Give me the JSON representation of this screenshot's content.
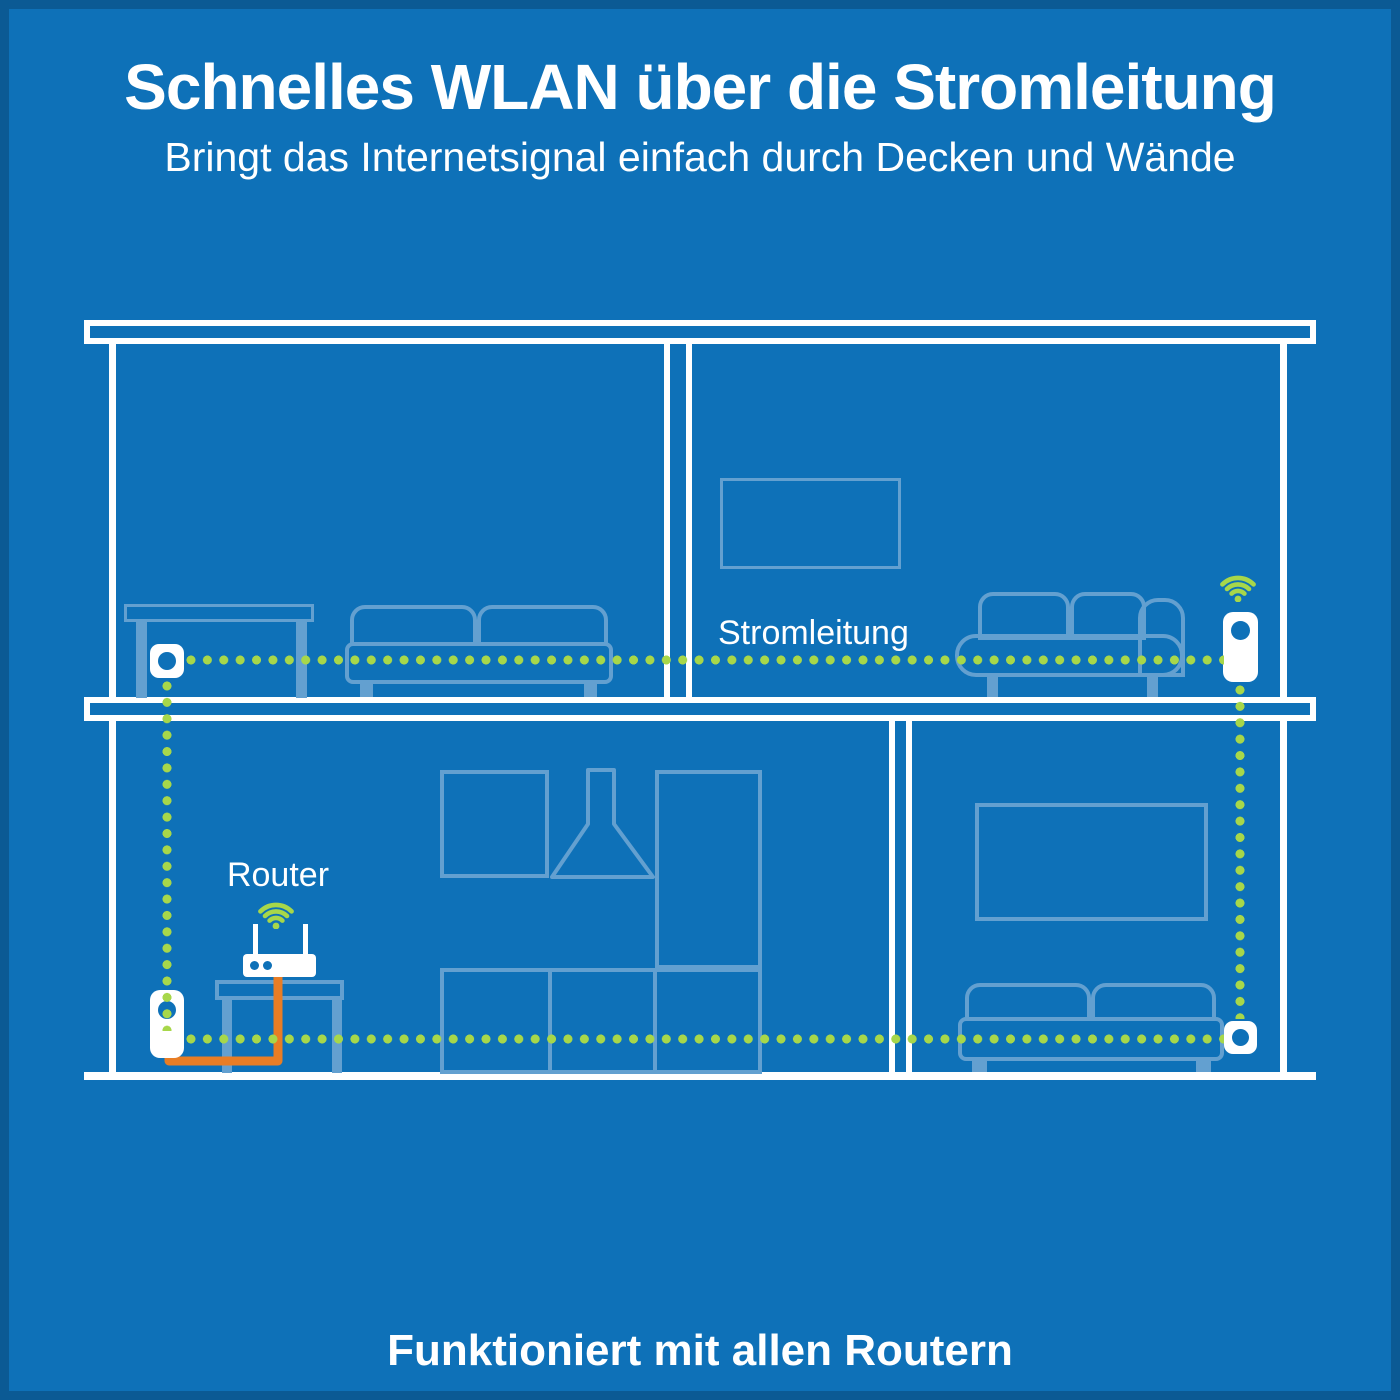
{
  "header": {
    "title": "Schnelles WLAN über die Stromleitung",
    "subtitle": "Bringt das Internetsignal einfach durch Decken und Wände"
  },
  "labels": {
    "powerline": "Stromleitung",
    "router": "Router"
  },
  "footer": {
    "text": "Funktioniert mit allen Routern"
  },
  "icons": {
    "wifi_upper": "wifi-icon",
    "wifi_router": "wifi-icon"
  },
  "theme": {
    "background": "#0E71B8",
    "edge": "#0B5F9E",
    "white": "#FFFFFF",
    "furniture": "#63A0D0",
    "green": "#A7D74A",
    "orange": "#E87D25"
  }
}
